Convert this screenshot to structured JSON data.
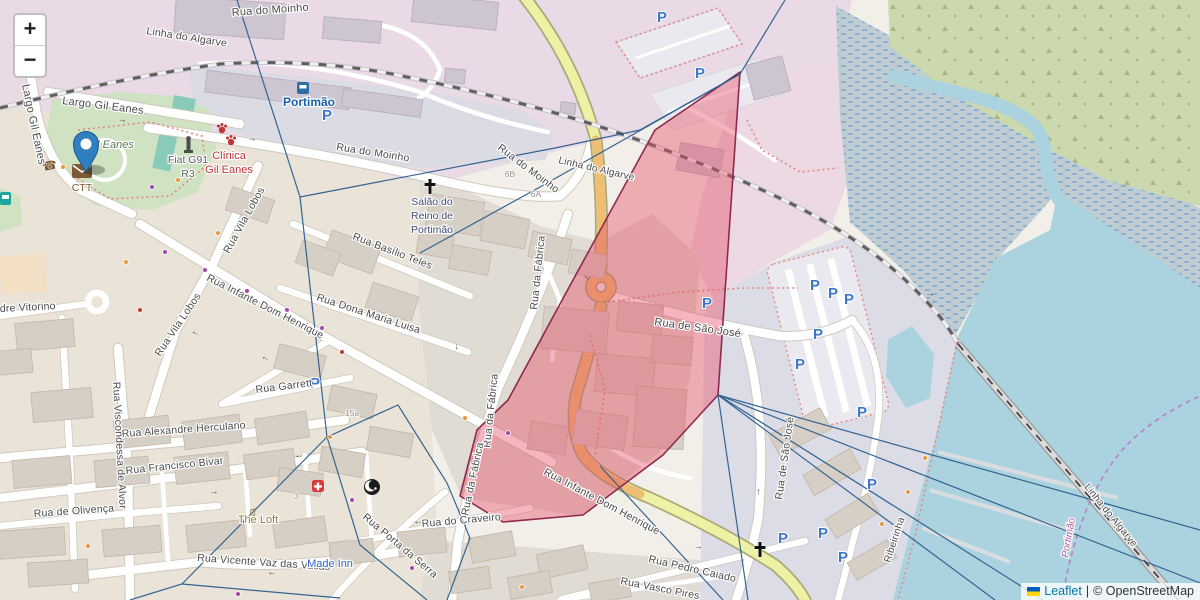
{
  "controls": {
    "zoom_in_label": "+",
    "zoom_out_label": "−"
  },
  "attribution": {
    "leaflet_link": "Leaflet",
    "separator": "|",
    "osm_text": "© OpenStreetMap"
  },
  "overlay": {
    "highlight_fill": "rgba(230,70,95,0.40)",
    "highlight_stroke": "#8e2a50",
    "line_color": "#2a5e8c",
    "highlight_polygon_points": "740,72 718,395 663,455 583,515 503,522 460,496 477,430 508,400 573,280 655,130",
    "voronoi_lines": [
      "237,0 300,197 327,437",
      "300,197 555,148 640,130 740,74 785,0",
      "740,74 540,187 420,253",
      "327,437 182,584 130,600",
      "182,584 340,598",
      "327,437 360,545 427,600",
      "327,437 398,405 447,483 470,538 447,600",
      "718,395 748,600",
      "718,395 995,600",
      "718,395 1043,600",
      "718,395 1200,583",
      "718,395 1200,530",
      "600,466 723,600"
    ]
  },
  "marker": {
    "x": 86,
    "y": 172
  },
  "map": {
    "parking_glyph": "P",
    "arrow_glyph": "→",
    "street_labels": [
      {
        "t": "Largo Gil Eanes",
        "x": 62,
        "y": 104,
        "r": 7,
        "s": 11
      },
      {
        "t": "Largo Gil Eanes",
        "x": 22,
        "y": 85,
        "r": 78,
        "s": 11
      },
      {
        "t": "Rua do Moinho",
        "x": 232,
        "y": 16,
        "r": -4,
        "s": 11
      },
      {
        "t": "Linha do Algarve",
        "x": 146,
        "y": 34,
        "r": 9,
        "s": 10.5,
        "c": "#6e6e6e"
      },
      {
        "t": "Rua do Moinho",
        "x": 336,
        "y": 150,
        "r": 9,
        "s": 10.5
      },
      {
        "t": "Rua do Moinho",
        "x": 497,
        "y": 149,
        "r": 37,
        "s": 10.5
      },
      {
        "t": "Linha do Algarve",
        "x": 558,
        "y": 163,
        "r": 13,
        "s": 10,
        "c": "#6e6e6e"
      },
      {
        "t": "Rua Basílio Teles",
        "x": 352,
        "y": 239,
        "r": 21,
        "s": 10.5
      },
      {
        "t": "Rua Dona Maria Luisa",
        "x": 316,
        "y": 300,
        "r": 18,
        "s": 10.5
      },
      {
        "t": "Rua da Fábrica",
        "x": 537,
        "y": 310,
        "r": -84,
        "s": 10.5
      },
      {
        "t": "Rua da Fábrica",
        "x": 490,
        "y": 448,
        "r": -84,
        "s": 10.5
      },
      {
        "t": "Rua da Fábrica",
        "x": 468,
        "y": 516,
        "r": -78,
        "s": 10.5
      },
      {
        "t": "Rua de São José",
        "x": 654,
        "y": 325,
        "r": 8,
        "s": 11
      },
      {
        "t": "Rua de São José",
        "x": 782,
        "y": 500,
        "r": -82,
        "s": 10.5
      },
      {
        "t": "Rua Vila Lobos",
        "x": 229,
        "y": 254,
        "r": -61,
        "s": 10.5
      },
      {
        "t": "Rua Vila Lobos",
        "x": 160,
        "y": 357,
        "r": -56,
        "s": 10.5
      },
      {
        "t": "Rua Infante Dom Henrique",
        "x": 206,
        "y": 280,
        "r": 27,
        "s": 10.5
      },
      {
        "t": "Rua Infante Dom Henrique",
        "x": 543,
        "y": 474,
        "r": 28,
        "s": 10.5
      },
      {
        "t": "Rua Garrett",
        "x": 256,
        "y": 393,
        "r": -7,
        "s": 10.5
      },
      {
        "t": "Rua Alexandre Herculano",
        "x": 122,
        "y": 437,
        "r": -4,
        "s": 10.5
      },
      {
        "t": "Rua Francisco Bivar",
        "x": 126,
        "y": 474,
        "r": -6,
        "s": 10.5
      },
      {
        "t": "Rua de Olivença",
        "x": 34,
        "y": 517,
        "r": -4,
        "s": 10.5
      },
      {
        "t": "Rua Vicente Vaz das Vacas",
        "x": 197,
        "y": 561,
        "r": 4,
        "s": 10.5
      },
      {
        "t": "Rua do Craveiro",
        "x": 422,
        "y": 527,
        "r": -5,
        "s": 10.5
      },
      {
        "t": "Rua Porta da Serra",
        "x": 362,
        "y": 518,
        "r": 40,
        "s": 10.5
      },
      {
        "t": "Rua Pedro Caiado",
        "x": 648,
        "y": 562,
        "r": 13,
        "s": 10.5
      },
      {
        "t": "Rua Vasco Pires",
        "x": 620,
        "y": 584,
        "r": 11,
        "s": 10.5
      },
      {
        "t": "dre Vitorino",
        "x": 0,
        "y": 312,
        "r": -3,
        "s": 10.5
      },
      {
        "t": "Rua Viscondessa de Alvor",
        "x": 113,
        "y": 382,
        "r": 87,
        "s": 10.5
      },
      {
        "t": "Linha do Algarve",
        "x": 1084,
        "y": 487,
        "r": 51,
        "s": 10,
        "c": "#6e6e6e"
      },
      {
        "t": "Ribeirinha",
        "x": 890,
        "y": 563,
        "r": -72,
        "s": 10,
        "c": "#666666"
      }
    ],
    "poi_labels": [
      {
        "t": "Portimão",
        "x": 283,
        "y": 106,
        "c": "#155fa8",
        "s": 12,
        "w": "bold"
      },
      {
        "t": "Portimão",
        "x": 1068,
        "y": 558,
        "c": "#a65aa0",
        "s": 10,
        "i": 1,
        "r": -80
      },
      {
        "t": "Salão do",
        "x": 432,
        "y": 205,
        "c": "#3e4a75",
        "s": 10.5,
        "a": "middle"
      },
      {
        "t": "Reino de",
        "x": 432,
        "y": 219,
        "c": "#3e4a75",
        "s": 10.5,
        "a": "middle"
      },
      {
        "t": "Portimão",
        "x": 432,
        "y": 233,
        "c": "#3e4a75",
        "s": 10.5,
        "a": "middle"
      },
      {
        "t": "Fiat G91",
        "x": 188,
        "y": 163,
        "c": "#5d5d5d",
        "s": 10.5,
        "a": "middle"
      },
      {
        "t": "R3",
        "x": 188,
        "y": 177,
        "c": "#5d5d5d",
        "s": 10.5,
        "a": "middle"
      },
      {
        "t": "Clínica",
        "x": 229,
        "y": 159,
        "c": "#c03535",
        "s": 11,
        "a": "middle"
      },
      {
        "t": "Gil Eanes",
        "x": 229,
        "y": 173,
        "c": "#c03535",
        "s": 11,
        "a": "middle"
      },
      {
        "t": "Gil Eanes",
        "x": 110,
        "y": 148,
        "c": "#5a7d52",
        "s": 11,
        "i": 1,
        "a": "middle"
      },
      {
        "t": "CTT",
        "x": 82,
        "y": 191,
        "c": "#7a5a33",
        "s": 10.5,
        "a": "middle"
      },
      {
        "t": "The Loft",
        "x": 258,
        "y": 523,
        "c": "#8f7d45",
        "s": 11,
        "a": "middle"
      },
      {
        "t": "Made Inn",
        "x": 330,
        "y": 567,
        "c": "#2f63c9",
        "s": 11,
        "a": "middle"
      }
    ],
    "house_numbers": [
      {
        "t": "6B",
        "x": 510,
        "y": 177
      },
      {
        "t": "6A",
        "x": 536,
        "y": 197
      },
      {
        "t": "3",
        "x": 296,
        "y": 499
      },
      {
        "t": "15a",
        "x": 352,
        "y": 416
      }
    ],
    "parking": [
      [
        327,
        120
      ],
      [
        662,
        22
      ],
      [
        700,
        78
      ],
      [
        707,
        308
      ],
      [
        815,
        290
      ],
      [
        833,
        298
      ],
      [
        849,
        304
      ],
      [
        818,
        339
      ],
      [
        800,
        369
      ],
      [
        862,
        417
      ],
      [
        872,
        489
      ],
      [
        783,
        543
      ],
      [
        823,
        538
      ],
      [
        843,
        562
      ],
      [
        315,
        388
      ]
    ],
    "dots": [
      {
        "x": 165,
        "y": 252,
        "c": "#a346ad"
      },
      {
        "x": 205,
        "y": 270,
        "c": "#a346ad"
      },
      {
        "x": 247,
        "y": 291,
        "c": "#a346ad"
      },
      {
        "x": 287,
        "y": 310,
        "c": "#a346ad"
      },
      {
        "x": 322,
        "y": 328,
        "c": "#a346ad"
      },
      {
        "x": 352,
        "y": 500,
        "c": "#a346ad"
      },
      {
        "x": 412,
        "y": 568,
        "c": "#a346ad"
      },
      {
        "x": 238,
        "y": 594,
        "c": "#a346ad"
      },
      {
        "x": 508,
        "y": 433,
        "c": "#a346ad"
      },
      {
        "x": 152,
        "y": 187,
        "c": "#a346ad"
      },
      {
        "x": 63,
        "y": 167,
        "c": "#e8963c"
      },
      {
        "x": 126,
        "y": 262,
        "c": "#e8963c"
      },
      {
        "x": 218,
        "y": 233,
        "c": "#e8963c"
      },
      {
        "x": 330,
        "y": 437,
        "c": "#e8963c"
      },
      {
        "x": 88,
        "y": 546,
        "c": "#e8963c"
      },
      {
        "x": 522,
        "y": 587,
        "c": "#e8963c"
      },
      {
        "x": 465,
        "y": 418,
        "c": "#e8963c"
      },
      {
        "x": 178,
        "y": 180,
        "c": "#e8963c"
      },
      {
        "x": 925,
        "y": 458,
        "c": "#e8963c"
      },
      {
        "x": 908,
        "y": 492,
        "c": "#e8963c"
      },
      {
        "x": 882,
        "y": 524,
        "c": "#e8963c"
      },
      {
        "x": 342,
        "y": 352,
        "c": "#c0392b"
      },
      {
        "x": 140,
        "y": 310,
        "c": "#c0392b"
      }
    ],
    "arrows": [
      [
        122,
        122,
        12
      ],
      [
        252,
        141,
        8
      ],
      [
        196,
        332,
        207
      ],
      [
        266,
        357,
        208
      ],
      [
        148,
        433,
        182
      ],
      [
        299,
        455,
        178
      ],
      [
        214,
        494,
        2
      ],
      [
        272,
        572,
        183
      ],
      [
        418,
        521,
        183
      ],
      [
        455,
        347,
        82
      ],
      [
        698,
        549,
        4
      ],
      [
        760,
        492,
        270
      ],
      [
        588,
        277,
        225
      ],
      [
        873,
        487,
        0
      ],
      [
        930,
        296,
        0
      ]
    ]
  }
}
